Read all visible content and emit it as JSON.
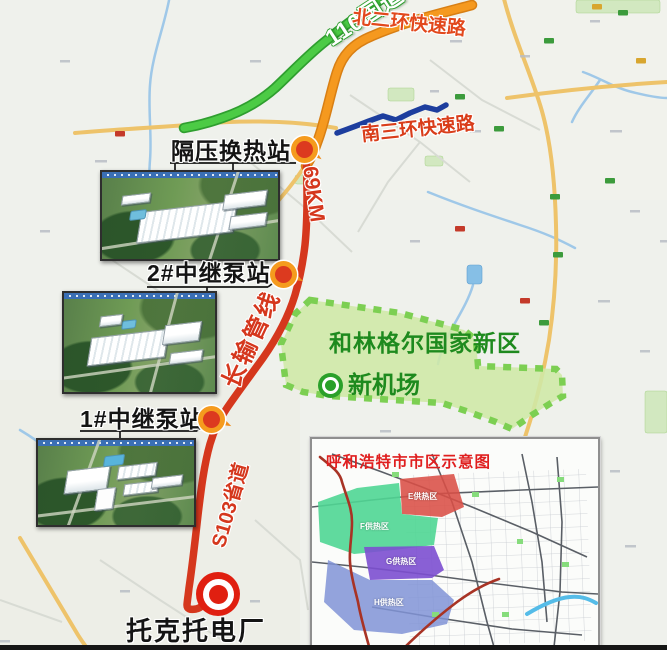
{
  "map": {
    "roads": {
      "g110_label": "110国道",
      "north_ring_label": "北二环快速路",
      "south_ring_label": "南三环快速路"
    },
    "pipeline": {
      "name_label": "长输管线",
      "distance_label": "69KM",
      "s103_label": "S103省道"
    },
    "stations": {
      "heat_exchange_label": "隔压换热站",
      "pump2_label": "2#中继泵站",
      "pump1_label": "1#中继泵站",
      "plant_label": "托克托电厂"
    },
    "new_area": {
      "name_label": "和林格尔国家新区",
      "airport_label": "新机场"
    }
  },
  "inset": {
    "title": "呼和浩特市市区示意图",
    "zones": [
      {
        "label": "E供热区",
        "color": "#d94f45"
      },
      {
        "label": "F供热区",
        "color": "#4fd694"
      },
      {
        "label": "G供热区",
        "color": "#7c4fd0"
      },
      {
        "label": "H供热区",
        "color": "#8093d6"
      }
    ]
  },
  "colors": {
    "pipeline_red": "#d5371d",
    "road_orange": "#f5991f",
    "road_green": "#4ccb45",
    "road_blue": "#1d3e9e",
    "road_yellow": "#eec36a",
    "new_area_fill": "#cfe8a6",
    "new_area_border": "#7ccf52",
    "new_area_text": "#1e8a1e",
    "road_label_red": "#e2481c",
    "marker_ring_orange": "#f59b1e",
    "marker_red": "#dc3a1f"
  }
}
